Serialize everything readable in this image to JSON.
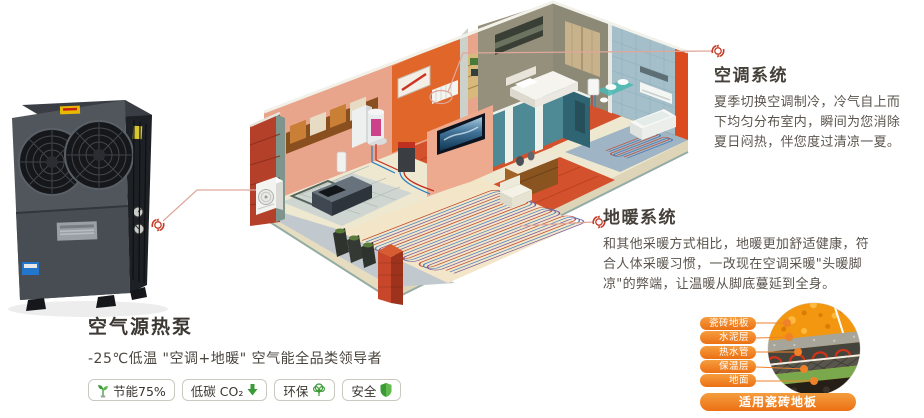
{
  "hero": {
    "product_title": "空气源热泵",
    "product_subtitle": "-25℃低温 \"空调+地暖\" 空气能全品类领导者",
    "badges": [
      {
        "icon": "sprout-icon",
        "label": "节能75%"
      },
      {
        "icon": "co2-down-arrow-icon",
        "label": "低碳 CO₂"
      },
      {
        "icon": "tree-icon",
        "label": "环保"
      },
      {
        "icon": "shield-icon",
        "label": "安全"
      }
    ]
  },
  "callouts": {
    "ac": {
      "title": "空调系统",
      "body": "夏季切换空调制冷，冷气自上而下均匀分布室内，瞬间为您消除夏日闷热，伴您度过清凉一夏。"
    },
    "floor_heating": {
      "title": "地暖系统",
      "body": "和其他采暖方式相比，地暖更加舒适健康，符合人体采暖习惯，一改现在空调采暖\"头暖脚凉\"的弊端，让温暖从脚底蔓延到全身。"
    }
  },
  "floor_diagram": {
    "layers": [
      {
        "label": "瓷砖地板"
      },
      {
        "label": "水泥层"
      },
      {
        "label": "热水管"
      },
      {
        "label": "保温层"
      },
      {
        "label": "地面"
      }
    ],
    "footer": "适用瓷砖地板"
  },
  "colors": {
    "accent_orange": "#f08228",
    "callout_line": "#dfa79a",
    "marker_red": "#c53b28",
    "badge_green": "#3a9a35",
    "title_text": "#45403a",
    "body_text": "#5a544d"
  }
}
